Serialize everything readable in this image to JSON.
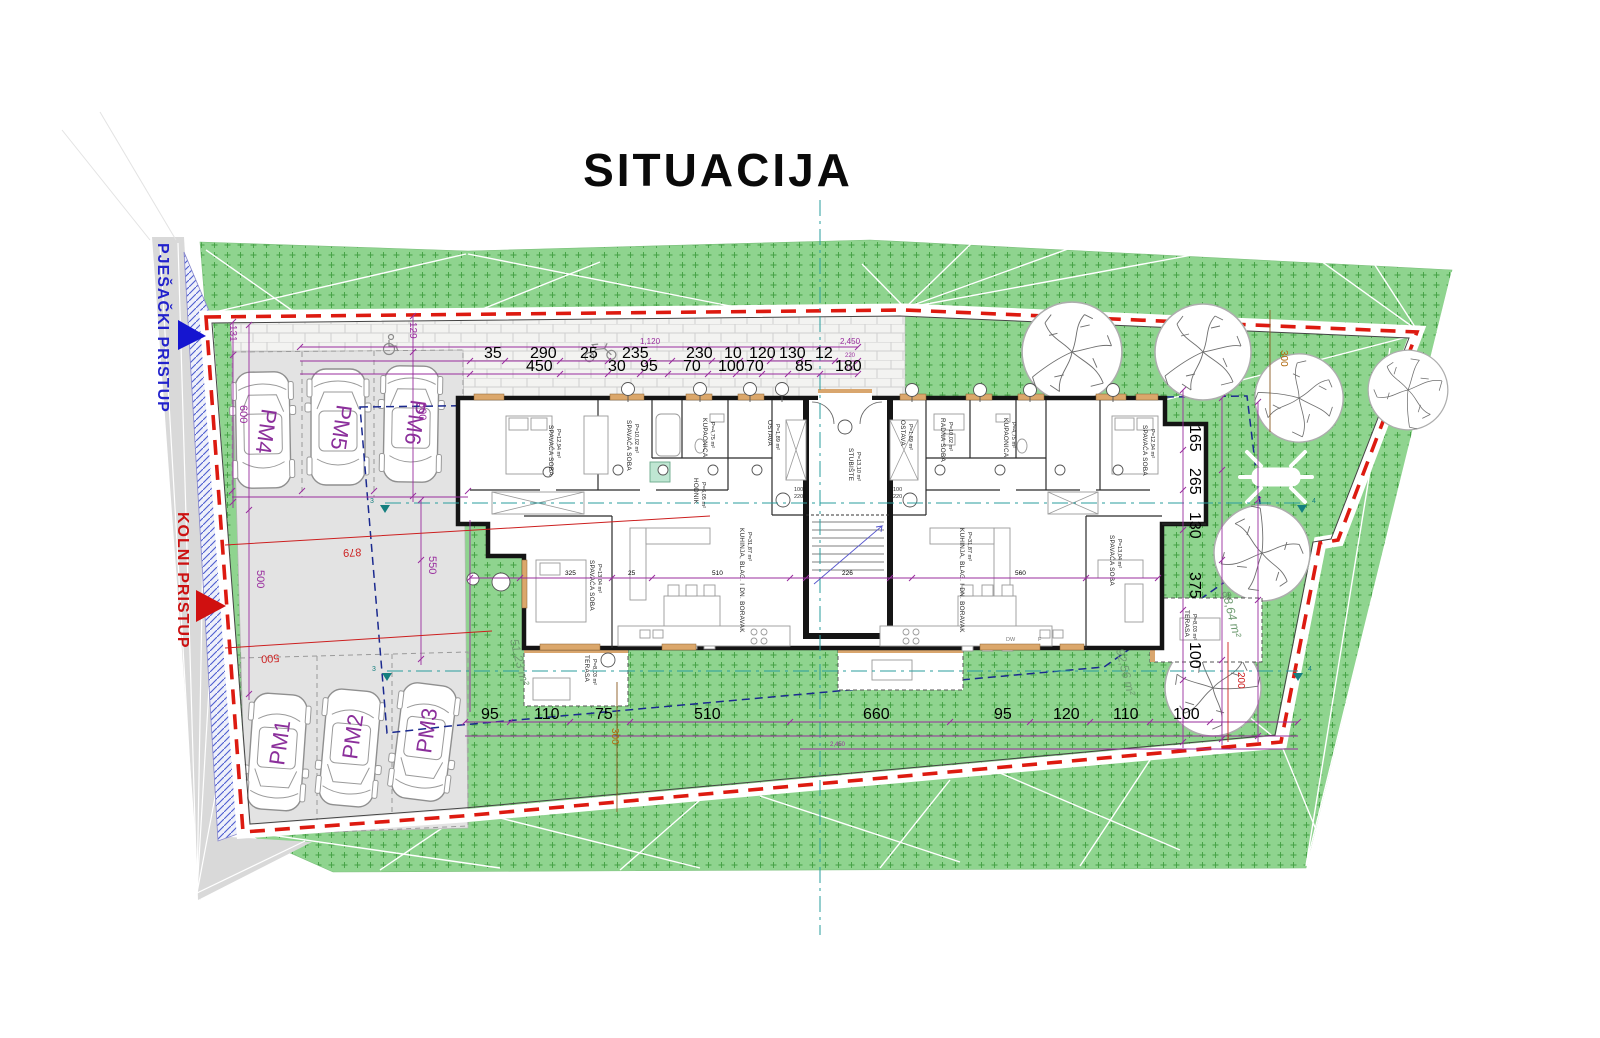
{
  "title": "SITUACIJA",
  "access": {
    "pedestrian_label": "PJEŠAČKI PRISTUP",
    "vehicle_label": "KOLNI PRISTUP"
  },
  "parking": {
    "pm1": "PM1",
    "pm2": "PM2",
    "pm3": "PM3",
    "pm4": "PM4",
    "pm5": "PM5",
    "pm6": "PM6"
  },
  "dimensions": {
    "building_width_top": "1,120",
    "left_edge": "131",
    "walkway": "129",
    "stall_depth_w": "600",
    "stall_depth_e": "600",
    "drive_length": "879",
    "drive_width": "550",
    "drive_width_w": "500",
    "drive_length_s": "500",
    "setback_ne": "300",
    "setback_s": "300",
    "setback_se": "200",
    "plot_width_bottom": "2,450",
    "top_row1": [
      "35",
      "290",
      "25",
      "235",
      "230",
      "10",
      "120",
      "130",
      "12"
    ],
    "top_row2": [
      "450",
      "30",
      "95",
      "70",
      "100",
      "70",
      "85",
      "180"
    ],
    "top_right_stack": [
      "2,450",
      "220",
      "220"
    ],
    "interior_row": [
      "325",
      "25",
      "510",
      "226",
      "560"
    ],
    "bottom_row": [
      "95",
      "110",
      "75",
      "510",
      "660",
      "95",
      "120",
      "110",
      "100"
    ],
    "side_row": [
      "165",
      "265",
      "130",
      "375",
      "100"
    ]
  },
  "areas": {
    "garden_w": "51,23 m²",
    "garden_e": "88,64 m²",
    "garden_s": "92,56 m²"
  },
  "axis_marks": {
    "west": "3",
    "east": "4"
  },
  "doors": {
    "left_w": "100",
    "left_h": "220",
    "right_w": "100",
    "right_h": "220"
  },
  "kitchen": {
    "dw": "DW",
    "f": "F"
  },
  "rooms": [
    {
      "label": "SPAVAĆA SOBA",
      "area": "P=12,94 m²"
    },
    {
      "label": "SPAVAĆA SOBA",
      "area": "P=10,02 m²"
    },
    {
      "label": "KUPAONICA",
      "area": "P=4,75 m²"
    },
    {
      "label": "HODNIK",
      "area": "P=6,05 m²"
    },
    {
      "label": "OSTAVA",
      "area": "P=1,89 m²"
    },
    {
      "label": "STUBIŠTE",
      "area": "P=13,10 m²"
    },
    {
      "label": "OSTAVA",
      "area": "P=1,89 m²"
    },
    {
      "label": "RADNA SOBA",
      "area": "P=10,02 m²"
    },
    {
      "label": "KUPAONICA",
      "area": "P=4,75 m²"
    },
    {
      "label": "SPAVAĆA SOBA",
      "area": "P=12,94 m²"
    },
    {
      "label": "SPAVAĆA SOBA",
      "area": "P=13,04 m²"
    },
    {
      "label": "KUHINJA, BLAG. I DN. BORAVAK",
      "area": "P=31,87 m²"
    },
    {
      "label": "KUHINJA, BLAG. I DN. BORAVAK",
      "area": "P=31,87 m²"
    },
    {
      "label": "SPAVAĆA SOBA",
      "area": "P=13,04 m²"
    },
    {
      "label": "TERASA",
      "area": "P=8,03 m²"
    },
    {
      "label": "TERASA",
      "area": "P=8,03 m²"
    }
  ],
  "colors": {
    "boundary_red": "#dd1a10",
    "envelope_navy": "#1b2a8f",
    "axis_teal": "#2a9d9d",
    "dim_purple": "#992d9e",
    "grass_green": "#8fd48f",
    "access_blue": "#1515d0",
    "access_red": "#d01010"
  }
}
